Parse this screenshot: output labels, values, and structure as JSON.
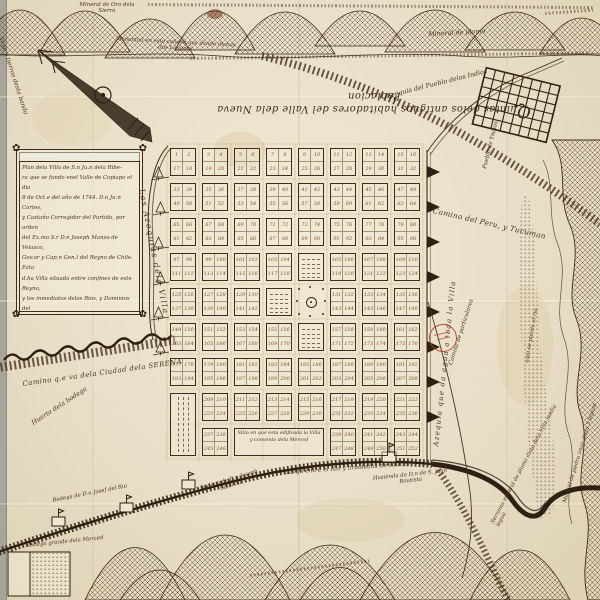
{
  "palette": {
    "paper": "#e9dfc8",
    "ink": "#3e2c19",
    "faded_ink": "#77552f",
    "stamp_red": "#b2382e"
  },
  "title": {
    "text": "Quintas delos antiguos habitadores del Valle dela Nueva Poblacion"
  },
  "cartouche": {
    "lines": [
      "Plan dela Villa de S.n Ju.n dela Ribe-",
      "ra que se fundo enel Valle de Copiapo el dia",
      "8 de Oct.e del año de 1744. D.n Ju.n Cortes,",
      "y Castaño Corregidor del Partido, por orden",
      "del Ex.mo S.r D.n Joseph Manso de Velasco,",
      "Gov.or y Cap.n Gen.l del Reyno de Chile. Esta",
      "d.ha Villa situada entre confines de este Reyno,",
      "y los inmediatos delos Rios, y Dominios del",
      "Tucuman, en 34 grados de altura, 46",
      "leguas distante del mar, y puerto dela Caldera,",
      "y 30 dela Sierra nevada; y llanuras crece-",
      "doras, abundantes de toda clase de maderas."
    ]
  },
  "labels": {
    "vega": "Vega y tierras desta banda",
    "mineral_oro": "Mineral de Oro dela Sierra",
    "manantial": "Manantial en esta cañada que divide dichas dos Lagunas",
    "mineral_plomo": "Mineral de plomo",
    "azequia_pueblo": "Azequia del Pueblo delos Indios",
    "pueblo_indios": "Pueblo de Yndios",
    "camino_peru": "Camino del Peru, y Tucuman",
    "left_azequia": "Las Azequias dela Villa",
    "right_azequia": "Azequia que da agua a toda la Villa",
    "camino_serena": "Camino q.e va dela Ciudad dela SERENA",
    "huerta": "Huerta dela bodega",
    "camino_part": "Camino de particulares",
    "pierde_rio": "aqui se pierde el rio",
    "sitio": "Sitio en que esta edificada la Villa y convento dela Merced",
    "zanja": "Zanja entre el Rio y arboledas de sauces",
    "hazienda": "Hazienda de D.n de S. Juan Bautista",
    "bodega1": "Bodega de D.n Josef del Rio",
    "bodega2": "Bodega grande dela Merced",
    "bodega3": "Bodega de D.n Joseph Saldivia",
    "serrania": "Serrania mineral de plomo dista dela Villa media legua",
    "piedra_iman": "Mineral de piedra iman dista 3 leguas"
  },
  "grid": {
    "rows": 9,
    "cols": 8,
    "numbering_start": 1,
    "special_blocks": {
      "plaza": {
        "row": 5,
        "col": 5
      },
      "scribble": [
        [
          4,
          5
        ],
        [
          5,
          4
        ],
        [
          6,
          5
        ]
      ],
      "tall_scribble": {
        "col": 1,
        "rows": [
          8,
          9
        ]
      },
      "wide_text": {
        "row": 9,
        "cols": [
          3,
          5
        ]
      }
    }
  }
}
